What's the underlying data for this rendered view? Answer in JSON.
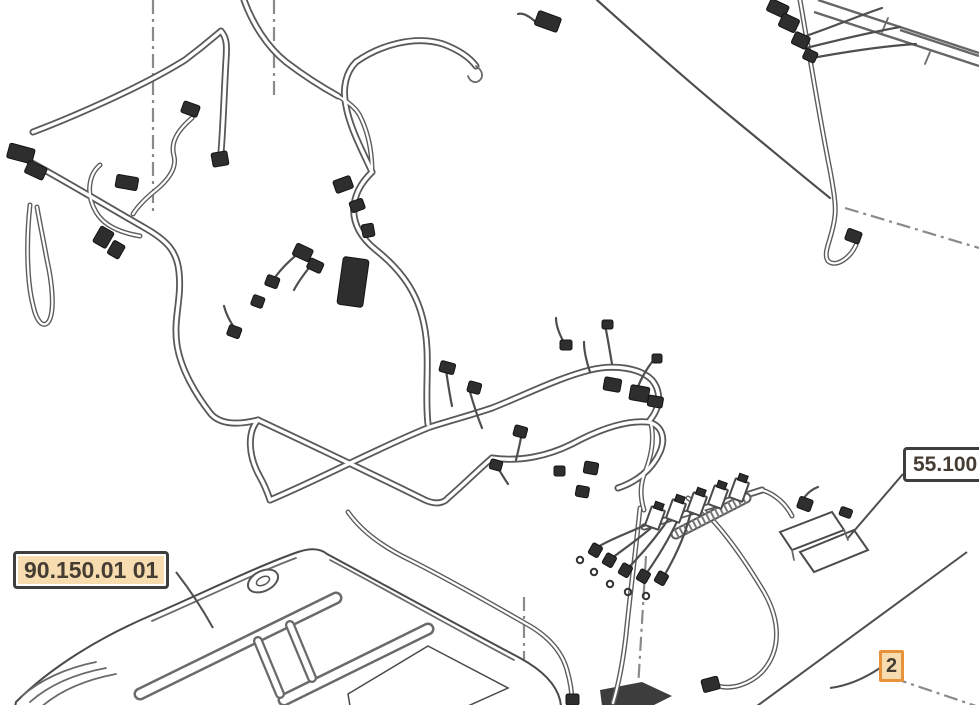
{
  "callouts": {
    "section_left": {
      "text": "90.150.01 01"
    },
    "section_right": {
      "text": "55.100"
    },
    "item": {
      "text": "2"
    }
  },
  "colors": {
    "highlight_bg": "#f6dcae",
    "orange_accent": "#e9923c",
    "label_border": "#3e3e3e",
    "label_text": "#453c33"
  }
}
